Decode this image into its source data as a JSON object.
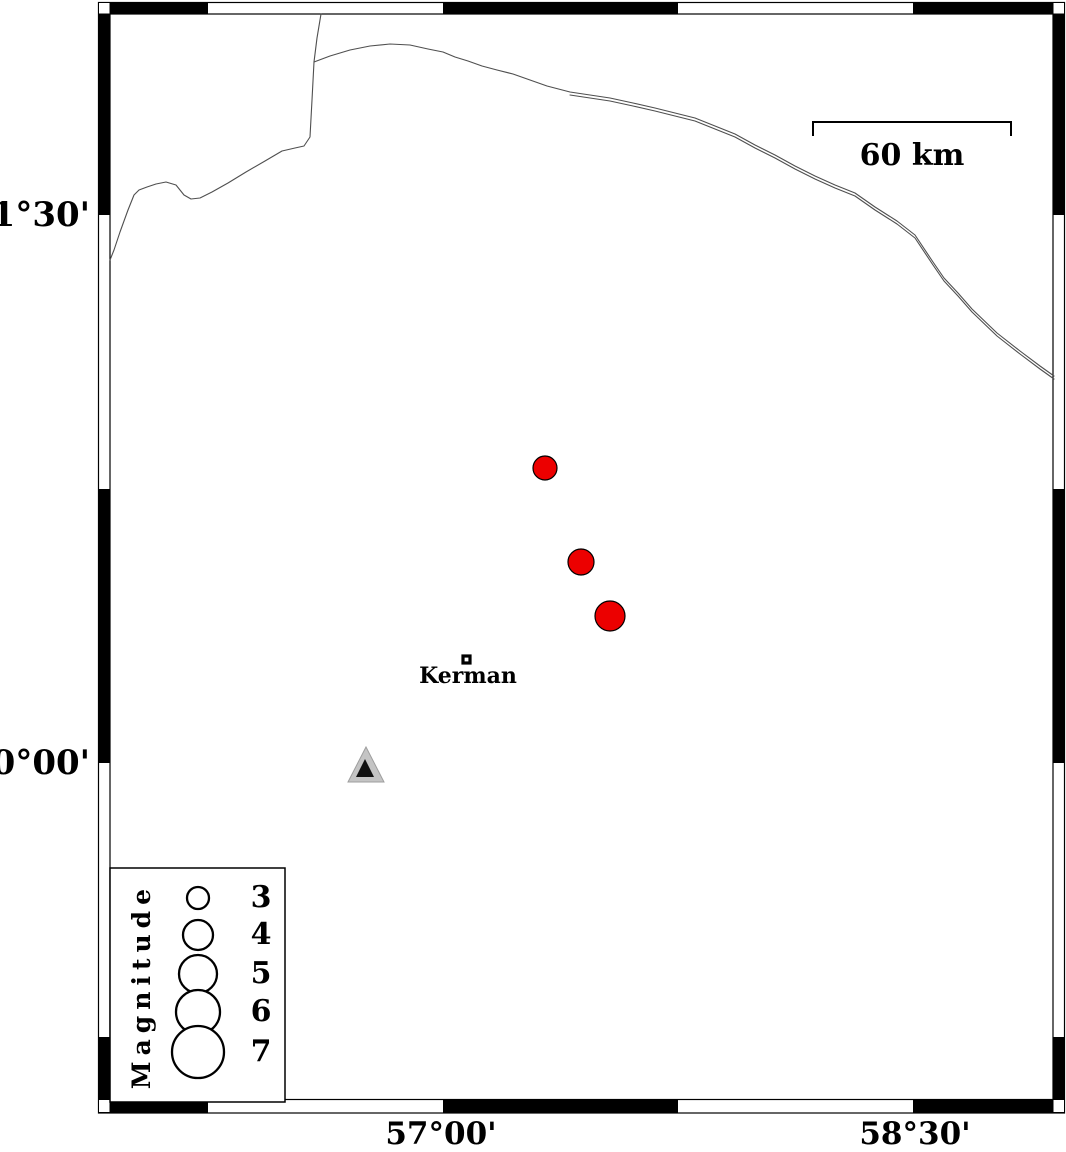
{
  "map": {
    "axes": {
      "left": [
        {
          "text": "31°30'",
          "y": 215
        },
        {
          "text": "30°00'",
          "y": 763
        }
      ],
      "bottom": [
        {
          "text": "57°00'",
          "x": 441
        },
        {
          "text": "58°30'",
          "x": 915
        }
      ]
    },
    "scale_bar": {
      "label": "60 km",
      "x_start": 813,
      "x_end": 1011,
      "y": 122
    },
    "city": {
      "label": "Kerman",
      "x": 466,
      "y": 659
    },
    "station": {
      "x": 366,
      "y": 769,
      "outer_color": "#c4c4c4",
      "inner_color": "#111111"
    },
    "earthquakes": {
      "color": "#ec0000",
      "items": [
        {
          "x": 545,
          "y": 468,
          "r": 12
        },
        {
          "x": 581,
          "y": 562,
          "r": 13
        },
        {
          "x": 610,
          "y": 616,
          "r": 15
        }
      ]
    },
    "frame_color": "#000000",
    "line_color": "#4f4f4f"
  },
  "legend": {
    "title": "Magnitude",
    "circle_x": 198,
    "entries": [
      {
        "label": "3",
        "r": 11,
        "cy": 898
      },
      {
        "label": "4",
        "r": 15,
        "cy": 935
      },
      {
        "label": "5",
        "r": 19,
        "cy": 974
      },
      {
        "label": "6",
        "r": 22,
        "cy": 1012
      },
      {
        "label": "7",
        "r": 26,
        "cy": 1052
      }
    ]
  }
}
